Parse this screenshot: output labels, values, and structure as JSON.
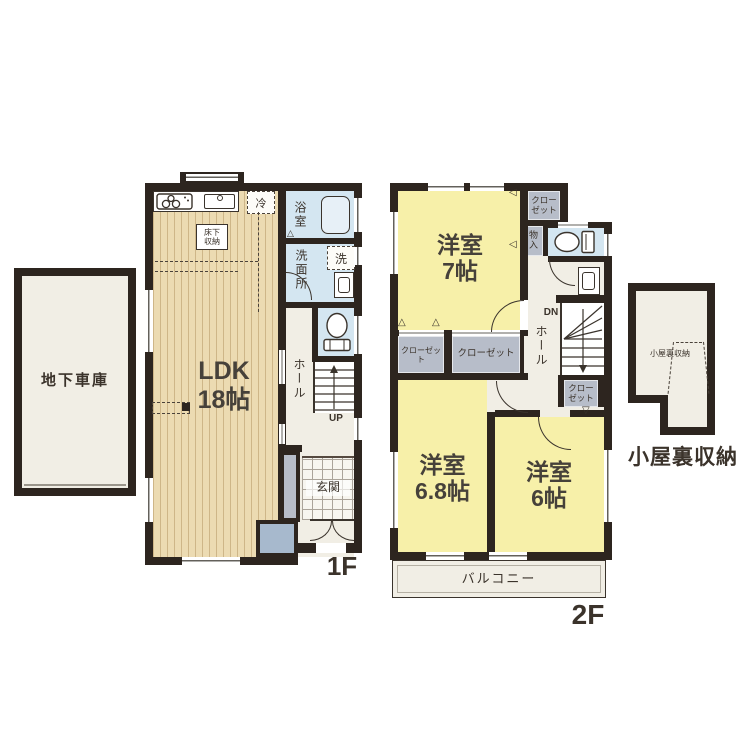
{
  "colors": {
    "wall": "#2d251f",
    "wood_floor": "#ecdbb2",
    "bedroom_yellow": "#f7f0a9",
    "water_blue": "#d4e6f1",
    "closet_gray": "#b7bdc9",
    "floor_offwhite": "#f1eee5",
    "entry_box_blue": "#a7b9cd",
    "text": "#3b332b"
  },
  "garage": {
    "label": "地下車庫"
  },
  "f1": {
    "floor_label": "1F",
    "ldk_name": "LDK",
    "ldk_size": "18帖",
    "underfloor_line1": "床下",
    "underfloor_line2": "収納",
    "fridge": "冷",
    "bath": "浴室",
    "washroom": "洗面所",
    "washer": "洗",
    "hall": "ホール",
    "stairs_up": "UP",
    "entrance": "玄関"
  },
  "f2": {
    "floor_label": "2F",
    "room7_name": "洋室",
    "room7_size": "7帖",
    "room68_name": "洋室",
    "room68_size": "6.8帖",
    "room6_name": "洋室",
    "room6_size": "6帖",
    "closet_left": "クローゼット",
    "closet_mid": "クローゼット",
    "closet_top_line1": "クロー",
    "closet_top_line2": "ゼット",
    "closet_stairs_line1": "クロー",
    "closet_stairs_line2": "ゼット",
    "storage": "物入",
    "hall": "ホール",
    "stairs_down": "DN",
    "balcony": "バルコニー"
  },
  "attic": {
    "inner_label": "小屋裏収納",
    "label": "小屋裏収納"
  }
}
